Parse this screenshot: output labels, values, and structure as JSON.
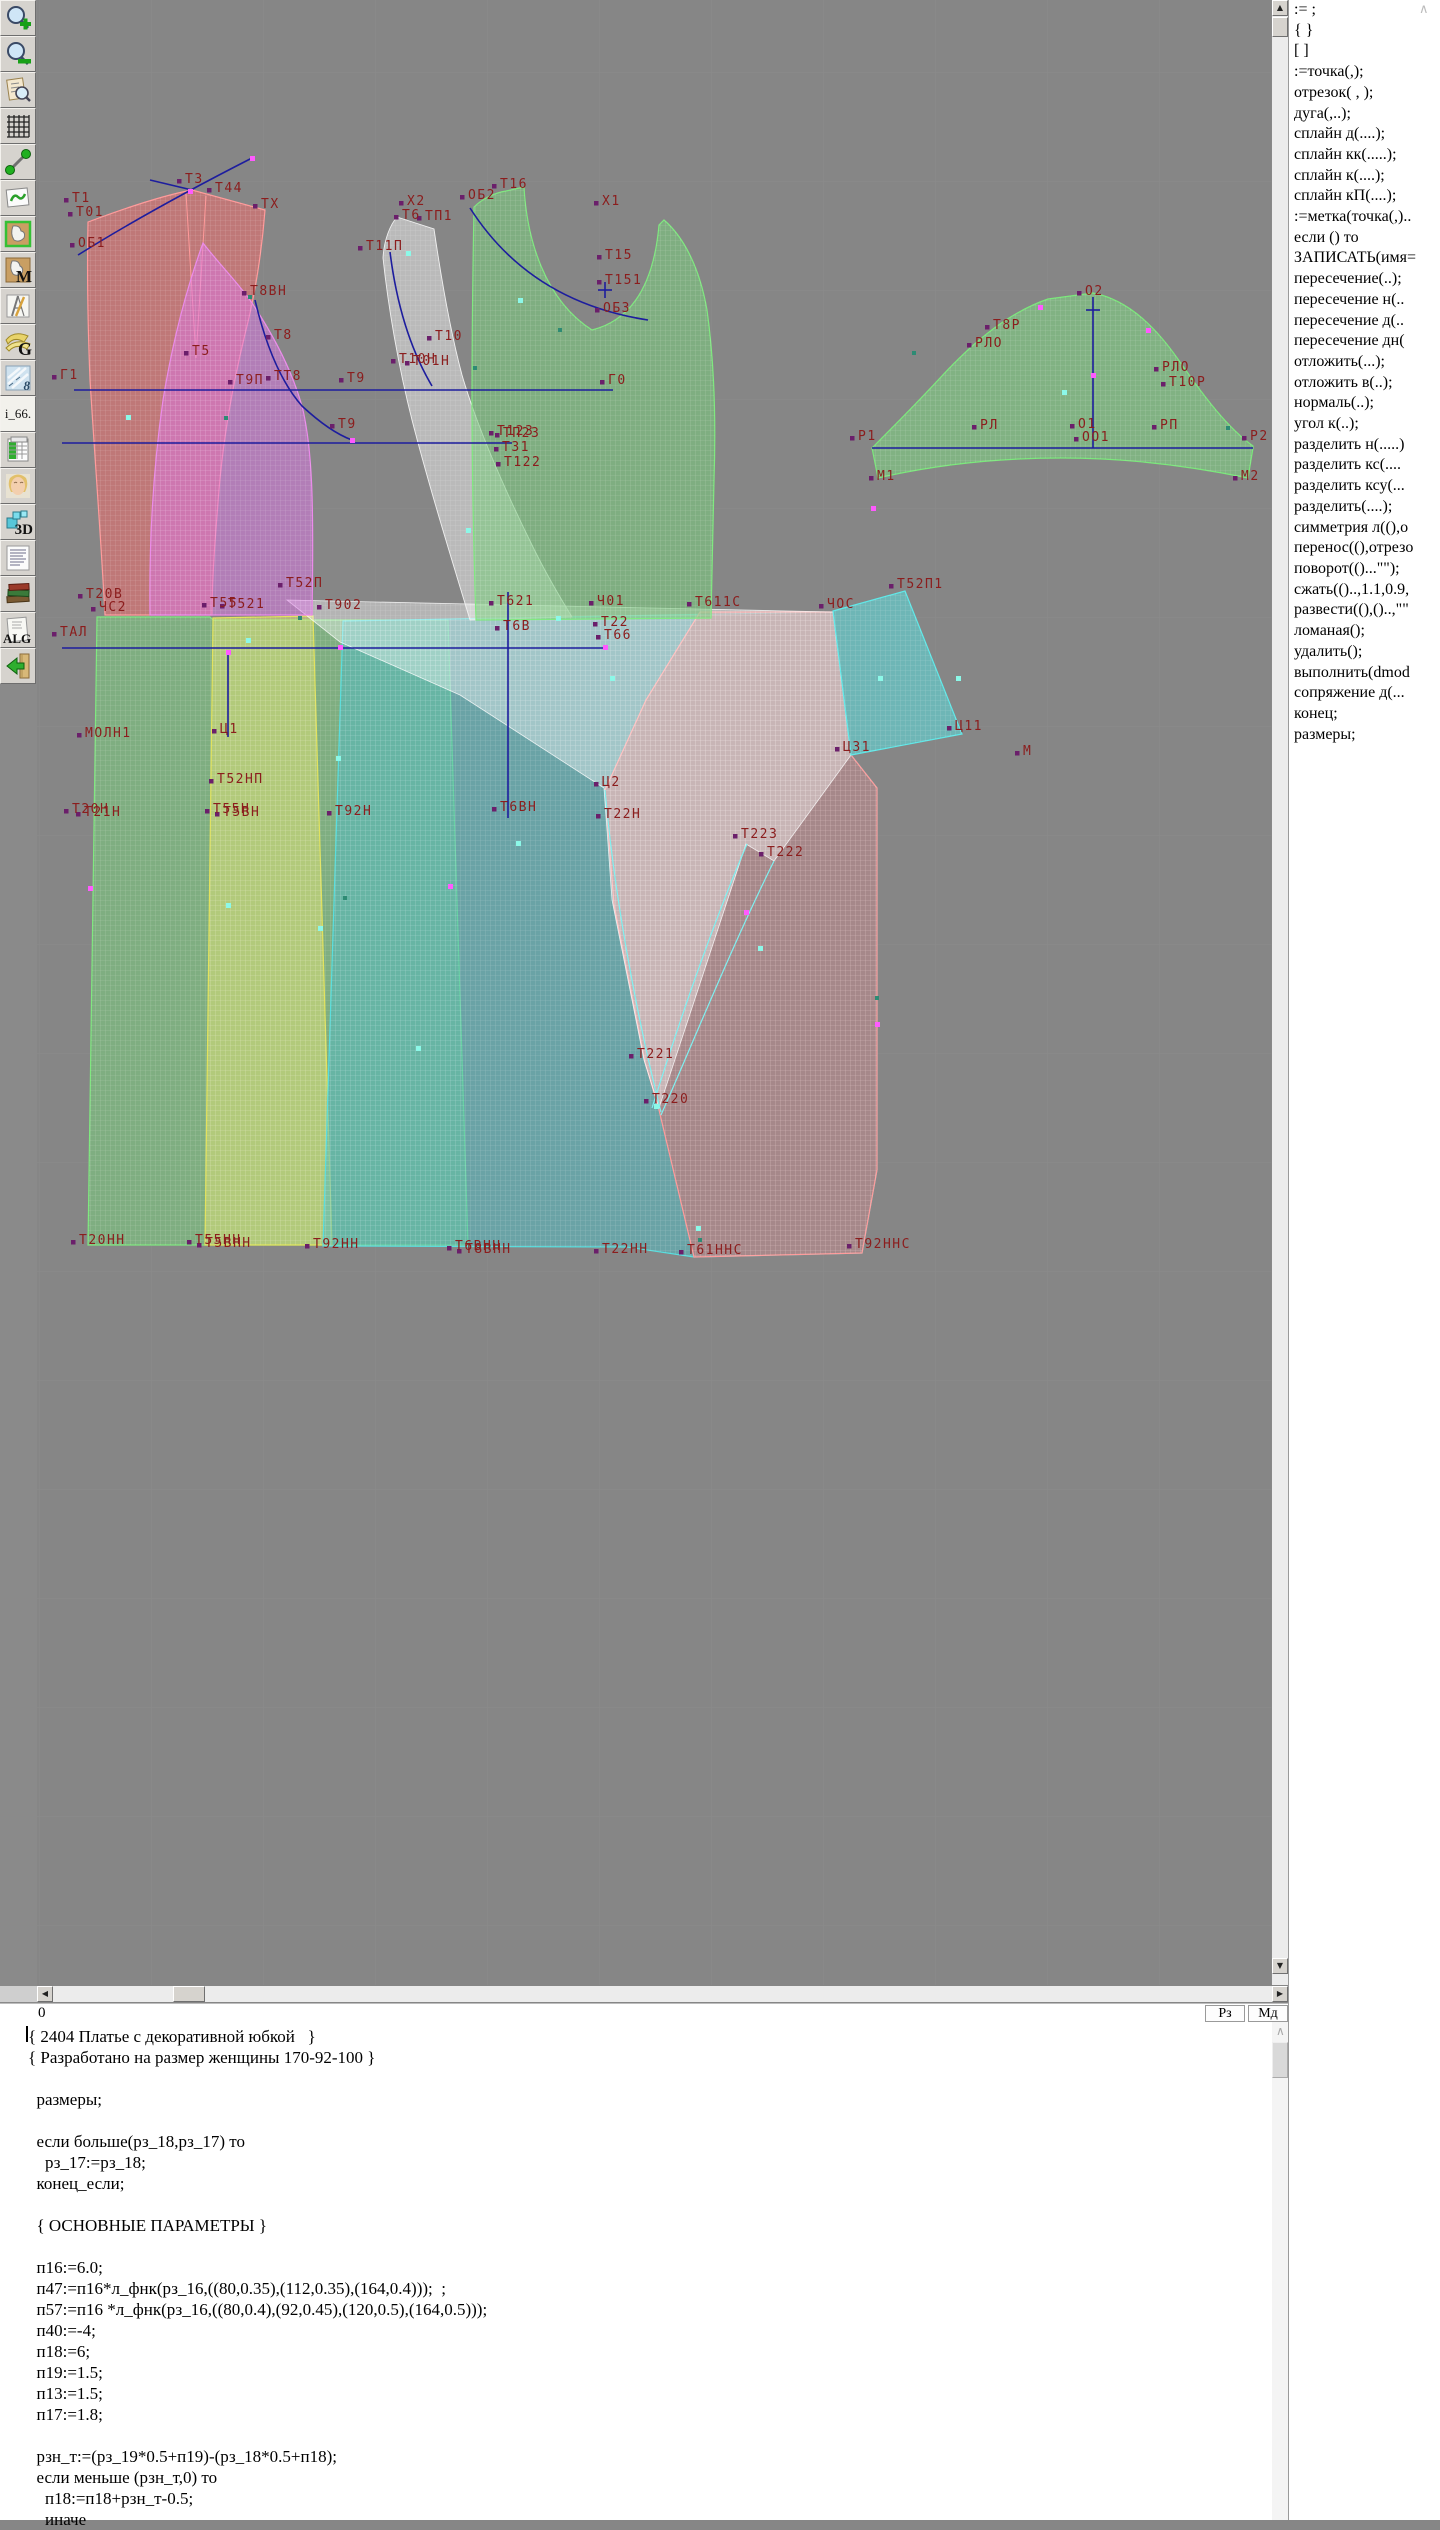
{
  "toolbar": {
    "glyphs": {
      "m": "M",
      "g": "G",
      "eight": "8",
      "i66": "i_66.",
      "d3": "3D",
      "alg": "ALG"
    }
  },
  "right_panel": {
    "commands": [
      ":= ;",
      "{  }",
      "[  ]",
      ":=точка(,);",
      "отрезок( , );",
      "дуга(,..);",
      "сплайн  д(....);",
      "сплайн  кк(.....);",
      "сплайн  к(....);",
      "сплайн  кП(....);",
      ":=метка(точка(,)..",
      "если () то",
      "ЗАПИСАТЬ(имя=",
      "пересечение(..);",
      "пересечение  н(..",
      "пересечение  д(..",
      "пересечение  дн(",
      "отложить(...);",
      "отложить  в(..);",
      "нормаль(..);",
      "угол  к(..);",
      "разделить  н(.....)",
      "разделить  кс(....",
      "разделить  ксу(...",
      "разделить(....);",
      "симметрия  л((),о",
      "перенос((),отрезо",
      "поворот(()...\"\");",
      "сжать(()..,1.1,0.9,",
      "развести((),()..,\"\"",
      "ломаная();",
      "удалить();",
      "выполнить(dmod",
      "сопряжение  д(...",
      "конец;",
      "размеры;"
    ]
  },
  "status_bar": {
    "left_value": "0",
    "rz_label": "Рз",
    "md_label": "Мд"
  },
  "code_area": {
    "lines": [
      "{ 2404 Платье с декоративной юбкой   }",
      "{ Разработано на размер женщины 170-92-100 }",
      "",
      "  размеры;",
      "",
      "  если больше(рз_18,рз_17) то",
      "    рз_17:=рз_18;",
      "  конец_если;",
      "",
      "  { ОСНОВНЫЕ ПАРАМЕТРЫ }",
      "",
      "  п16:=6.0;",
      "  п47:=п16*л_фнк(рз_16,((80,0.35),(112,0.35),(164,0.4)));  ;",
      "  п57:=п16 *л_фнк(рз_16,((80,0.4),(92,0.45),(120,0.5),(164,0.5)));",
      "  п40:=-4;",
      "  п18:=6;",
      "  п19:=1.5;",
      "  п13:=1.5;",
      "  п17:=1.8;",
      "",
      "  рзн_т:=(рз_19*0.5+п19)-(рз_18*0.5+п18);",
      "  если меньше (рзн_т,0) то",
      "    п18:=п18+рзн_т-0.5;",
      "    иначе"
    ]
  },
  "canvas": {
    "label_color": "#8b1d1d",
    "line_color": "#1d1d9e",
    "labels": [
      [
        "Т1",
        72,
        202
      ],
      [
        "Т01",
        76,
        216
      ],
      [
        "ОБ1",
        78,
        247
      ],
      [
        "Т3",
        185,
        183
      ],
      [
        "Т44",
        215,
        192
      ],
      [
        "ТХ",
        261,
        208
      ],
      [
        "Т8ВН",
        250,
        295
      ],
      [
        "Т8",
        274,
        339
      ],
      [
        "Т5",
        192,
        355
      ],
      [
        "Г1",
        60,
        379
      ],
      [
        "ТТ8",
        274,
        380
      ],
      [
        "Т9П",
        236,
        384
      ],
      [
        "Т9",
        347,
        382
      ],
      [
        "Т9",
        338,
        428
      ],
      [
        "Х2",
        407,
        205
      ],
      [
        "Т6",
        402,
        219
      ],
      [
        "ТП1",
        425,
        220
      ],
      [
        "Т11П",
        366,
        250
      ],
      [
        "ОБ2",
        468,
        199
      ],
      [
        "Т16",
        500,
        188
      ],
      [
        "Х1",
        602,
        205
      ],
      [
        "Т15",
        605,
        259
      ],
      [
        "Т151",
        605,
        284
      ],
      [
        "ОБ3",
        603,
        312
      ],
      [
        "Т10",
        435,
        340
      ],
      [
        "Т10Н",
        399,
        363
      ],
      [
        "Т01Н",
        413,
        365
      ],
      [
        "Г0",
        608,
        384
      ],
      [
        "Т123",
        497,
        435
      ],
      [
        "ТП23",
        503,
        437
      ],
      [
        "Т31",
        502,
        451
      ],
      [
        "Т122",
        504,
        466
      ],
      [
        "О2",
        1085,
        295
      ],
      [
        "Т8Р",
        993,
        329
      ],
      [
        "РЛО",
        975,
        347
      ],
      [
        "РЛО",
        1162,
        371
      ],
      [
        "Т10Р",
        1169,
        386
      ],
      [
        "РЛ",
        980,
        429
      ],
      [
        "О1",
        1078,
        428
      ],
      [
        "ОО1",
        1082,
        441
      ],
      [
        "РП",
        1160,
        429
      ],
      [
        "Р1",
        858,
        440
      ],
      [
        "Р2",
        1250,
        440
      ],
      [
        "М1",
        877,
        480
      ],
      [
        "М2",
        1241,
        480
      ],
      [
        "Т20В",
        86,
        598
      ],
      [
        "ЧС2",
        99,
        611
      ],
      [
        "ТАЛ",
        60,
        636
      ],
      [
        "Т55",
        210,
        607
      ],
      [
        "Т521",
        228,
        608
      ],
      [
        "Т52П",
        286,
        587
      ],
      [
        "Т902",
        325,
        609
      ],
      [
        "Т621",
        497,
        605
      ],
      [
        "Т6В",
        503,
        630
      ],
      [
        "Ч01",
        597,
        605
      ],
      [
        "Т22",
        601,
        626
      ],
      [
        "Т66",
        604,
        639
      ],
      [
        "Т611С",
        695,
        606
      ],
      [
        "ЧОС",
        827,
        608
      ],
      [
        "Т52П1",
        897,
        588
      ],
      [
        "Ц11",
        955,
        730
      ],
      [
        "Ц31",
        843,
        751
      ],
      [
        "М",
        1023,
        755
      ],
      [
        "МОЛН1",
        85,
        737
      ],
      [
        "Ц1",
        220,
        733
      ],
      [
        "Т52НП",
        217,
        783
      ],
      [
        "Т20Н",
        72,
        813
      ],
      [
        "Т21Н",
        84,
        816
      ],
      [
        "Т55Н",
        213,
        813
      ],
      [
        "Т5ВН",
        223,
        816
      ],
      [
        "Т92Н",
        335,
        815
      ],
      [
        "Т6ВН",
        500,
        811
      ],
      [
        "Ц2",
        602,
        786
      ],
      [
        "Т22Н",
        604,
        818
      ],
      [
        "Т223",
        741,
        838
      ],
      [
        "Т222",
        767,
        856
      ],
      [
        "Т221",
        637,
        1058
      ],
      [
        "Т220",
        652,
        1103
      ],
      [
        "Т20НН",
        79,
        1244
      ],
      [
        "Т55НН",
        195,
        1244
      ],
      [
        "Т5ВНН",
        205,
        1247
      ],
      [
        "Т92НН",
        313,
        1248
      ],
      [
        "Т6ВНН",
        455,
        1250
      ],
      [
        "Т8ВНН",
        465,
        1253
      ],
      [
        "Т22НН",
        602,
        1253
      ],
      [
        "Т61ННС",
        687,
        1254
      ],
      [
        "Т92ННС",
        855,
        1248
      ]
    ],
    "blue_lines": [
      [
        74,
        390,
        613,
        390
      ],
      [
        62,
        443,
        512,
        443
      ],
      [
        62,
        648,
        605,
        648
      ],
      [
        228,
        652,
        228,
        737
      ],
      [
        508,
        592,
        508,
        818
      ],
      [
        1093,
        297,
        1093,
        448
      ],
      [
        872,
        448,
        1253,
        448
      ],
      [
        605,
        282,
        605,
        298
      ],
      [
        598,
        290,
        612,
        290
      ],
      [
        1086,
        310,
        1100,
        310
      ]
    ],
    "blue_paths": [
      "M78,255 Q150,210 252,158",
      "M150,180 L192,190",
      "M255,300 Q272,372 302,406 Q330,432 352,440",
      "M470,208 Q530,302 648,320",
      "M390,252 Q400,332 432,386"
    ],
    "cyan_curves": [
      "M605,790 C615,905 640,1030 661,1112",
      "M774,861 C730,950 690,1050 661,1115",
      "M747,844 C706,940 672,1045 652,1108"
    ],
    "magenta_points": [
      [
        190,
        191
      ],
      [
        252,
        158
      ],
      [
        340,
        647
      ],
      [
        605,
        647
      ],
      [
        1040,
        307
      ],
      [
        1148,
        330
      ],
      [
        873,
        508
      ],
      [
        228,
        652
      ],
      [
        90,
        888
      ],
      [
        450,
        886
      ],
      [
        877,
        1024
      ],
      [
        746,
        912
      ],
      [
        352,
        440
      ],
      [
        1093,
        375
      ]
    ],
    "cyan_points": [
      [
        128,
        417
      ],
      [
        248,
        640
      ],
      [
        338,
        758
      ],
      [
        418,
        1048
      ],
      [
        518,
        843
      ],
      [
        612,
        678
      ],
      [
        760,
        948
      ],
      [
        880,
        678
      ],
      [
        1064,
        392
      ],
      [
        468,
        530
      ],
      [
        320,
        928
      ],
      [
        656,
        1106
      ],
      [
        558,
        618
      ],
      [
        698,
        1228
      ],
      [
        408,
        253
      ],
      [
        958,
        678
      ],
      [
        228,
        905
      ],
      [
        520,
        300
      ]
    ],
    "teal_points": [
      [
        250,
        297
      ],
      [
        226,
        418
      ],
      [
        475,
        368
      ],
      [
        914,
        353
      ],
      [
        1228,
        428
      ],
      [
        345,
        898
      ],
      [
        877,
        998
      ],
      [
        560,
        330
      ],
      [
        300,
        618
      ],
      [
        700,
        1240
      ]
    ]
  }
}
